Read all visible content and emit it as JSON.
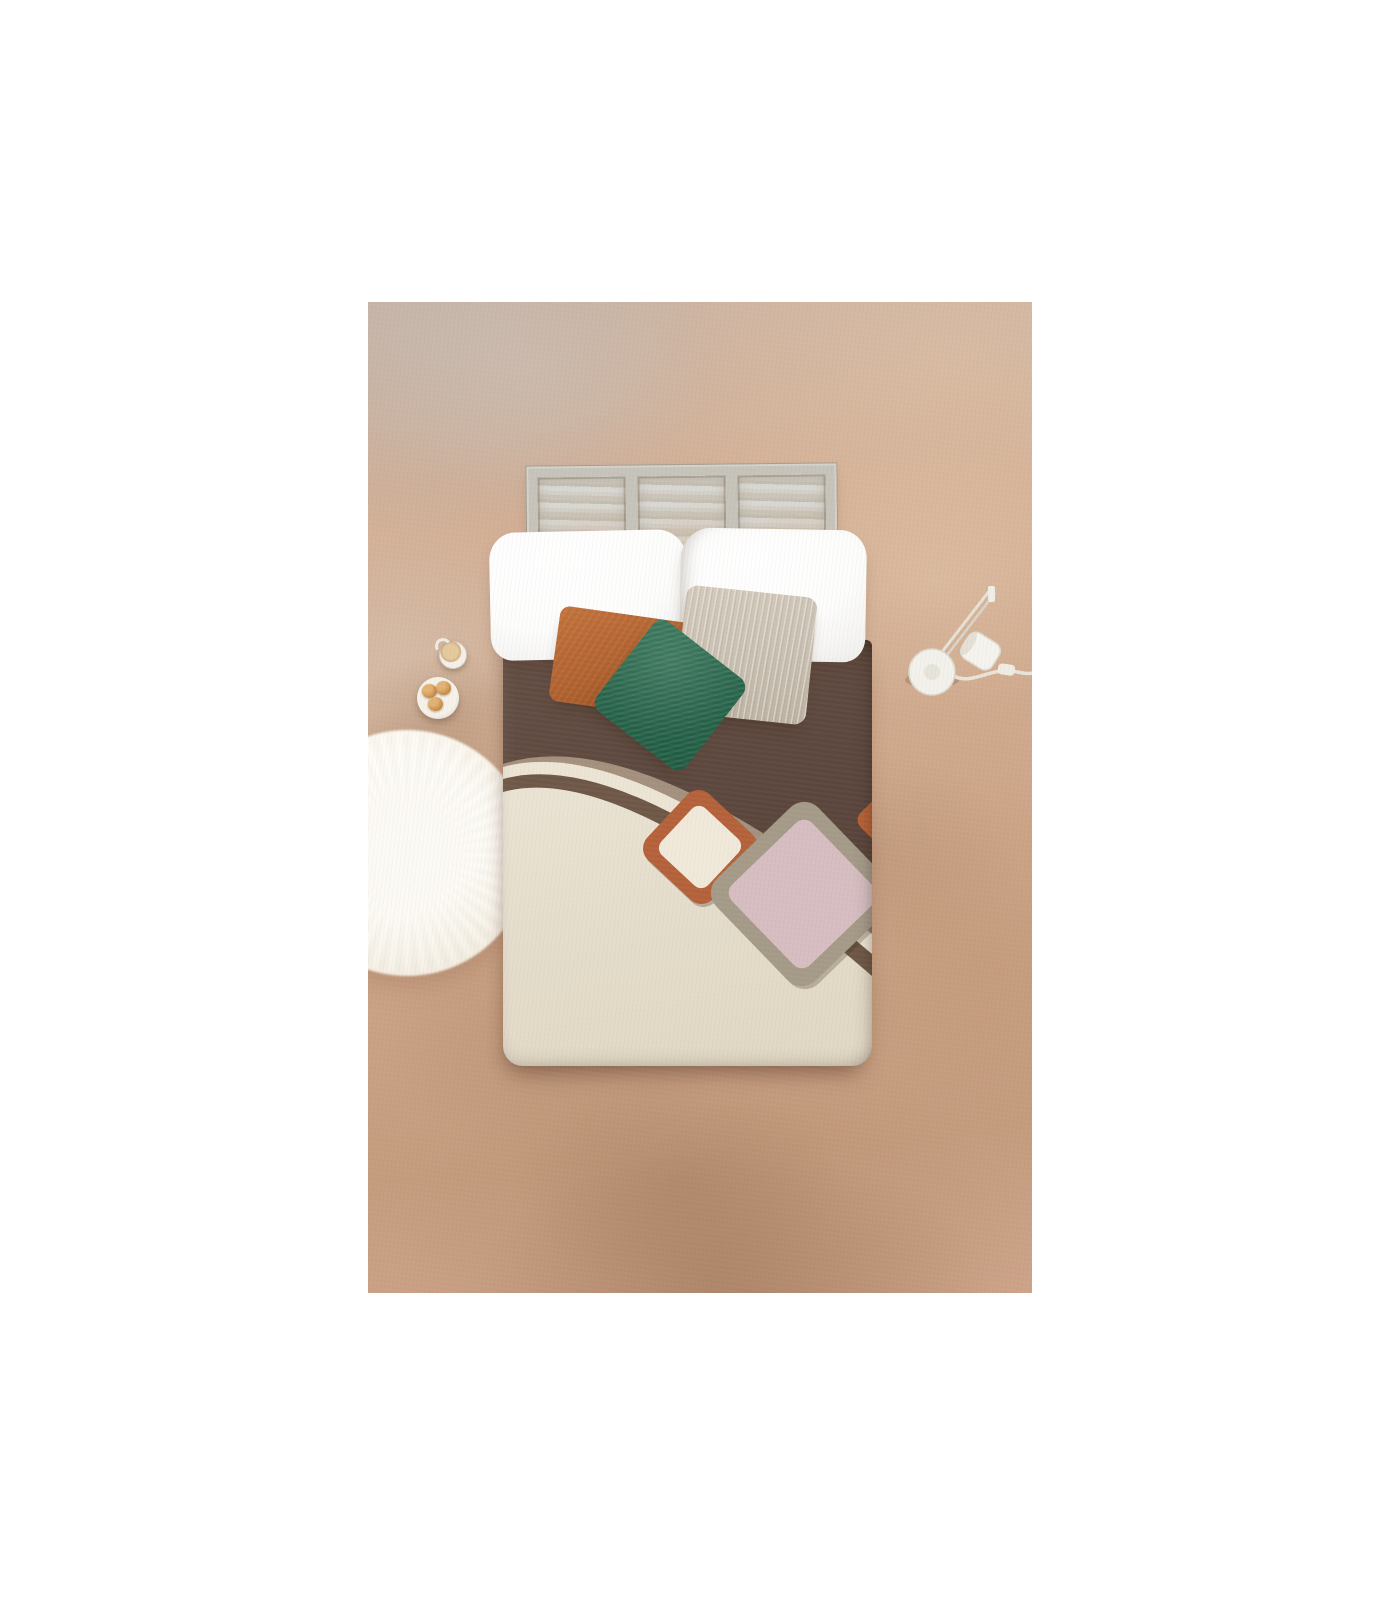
{
  "meta": {
    "type": "product-photograph",
    "description": "Top-down photo of a bed styled with white pillows, rust, green and beige cushions and a two-tone brown and cream duvet with retro arc and rounded-square motifs, on a mottled terracotta plaster floor with a sheepskin rug, coffee cup, pastry plate and white task lamp",
    "canvas": "1400x1600",
    "photo_area": "664x991 centered on white"
  },
  "objects": {
    "floor": {
      "label": "terracotta plaster floor",
      "base_color": "#cfa98c"
    },
    "window_headboard": {
      "label": "weathered 3-panel window headboard",
      "panels": 3,
      "frame_color": "#c6c3ba",
      "panel_color": "#c9c6bd"
    },
    "pillow_left": {
      "label": "white pillow left",
      "color": "#fdfdfc"
    },
    "pillow_right": {
      "label": "white pillow right",
      "color": "#fdfdfc"
    },
    "cushion_rust": {
      "label": "rust cushion",
      "color": "#b2622f"
    },
    "cushion_beige": {
      "label": "beige crinkle cushion",
      "color": "#c8bfb1"
    },
    "cushion_green": {
      "label": "green crinkle cushion",
      "color": "#26634a"
    },
    "duvet": {
      "label": "two-tone duvet with arcs and rounded squares",
      "top_color": "#5c473d",
      "body_color": "#e7dfcf",
      "arc_band_colors": [
        "#a3907d",
        "#ece5d5",
        "#6e5746"
      ],
      "small_square": {
        "border": "#b4613a",
        "fill": "#f0e9da"
      },
      "large_square": {
        "border": "#a59a88",
        "fill": "#d6bdc1"
      },
      "edge_sliver": {
        "color": "#b56136"
      }
    },
    "rug": {
      "label": "white sheepskin round rug",
      "color": "#faf6ec"
    },
    "cup": {
      "label": "white cup with coffee",
      "color": "#f4f1ea",
      "coffee_color": "#d4b184"
    },
    "plate": {
      "label": "plate with three pastries",
      "pastry_count": 3,
      "pastry_color": "#cb8f4c"
    },
    "lamp": {
      "label": "white articulated task lamp",
      "color": "#f3f1ec"
    }
  },
  "palette": {
    "background": "#ffffff",
    "floor_light": "#d2ae93",
    "floor_dark": "#c49b7d",
    "duvet_brown": "#5c473d",
    "duvet_cream": "#e7dfcf",
    "taupe_band": "#a3907d",
    "dark_band": "#6e5746",
    "terracotta": "#b4613a",
    "dusty_pink": "#d6bdc1",
    "green": "#26634a",
    "rust": "#b2622f",
    "beige": "#c8bfb1"
  }
}
